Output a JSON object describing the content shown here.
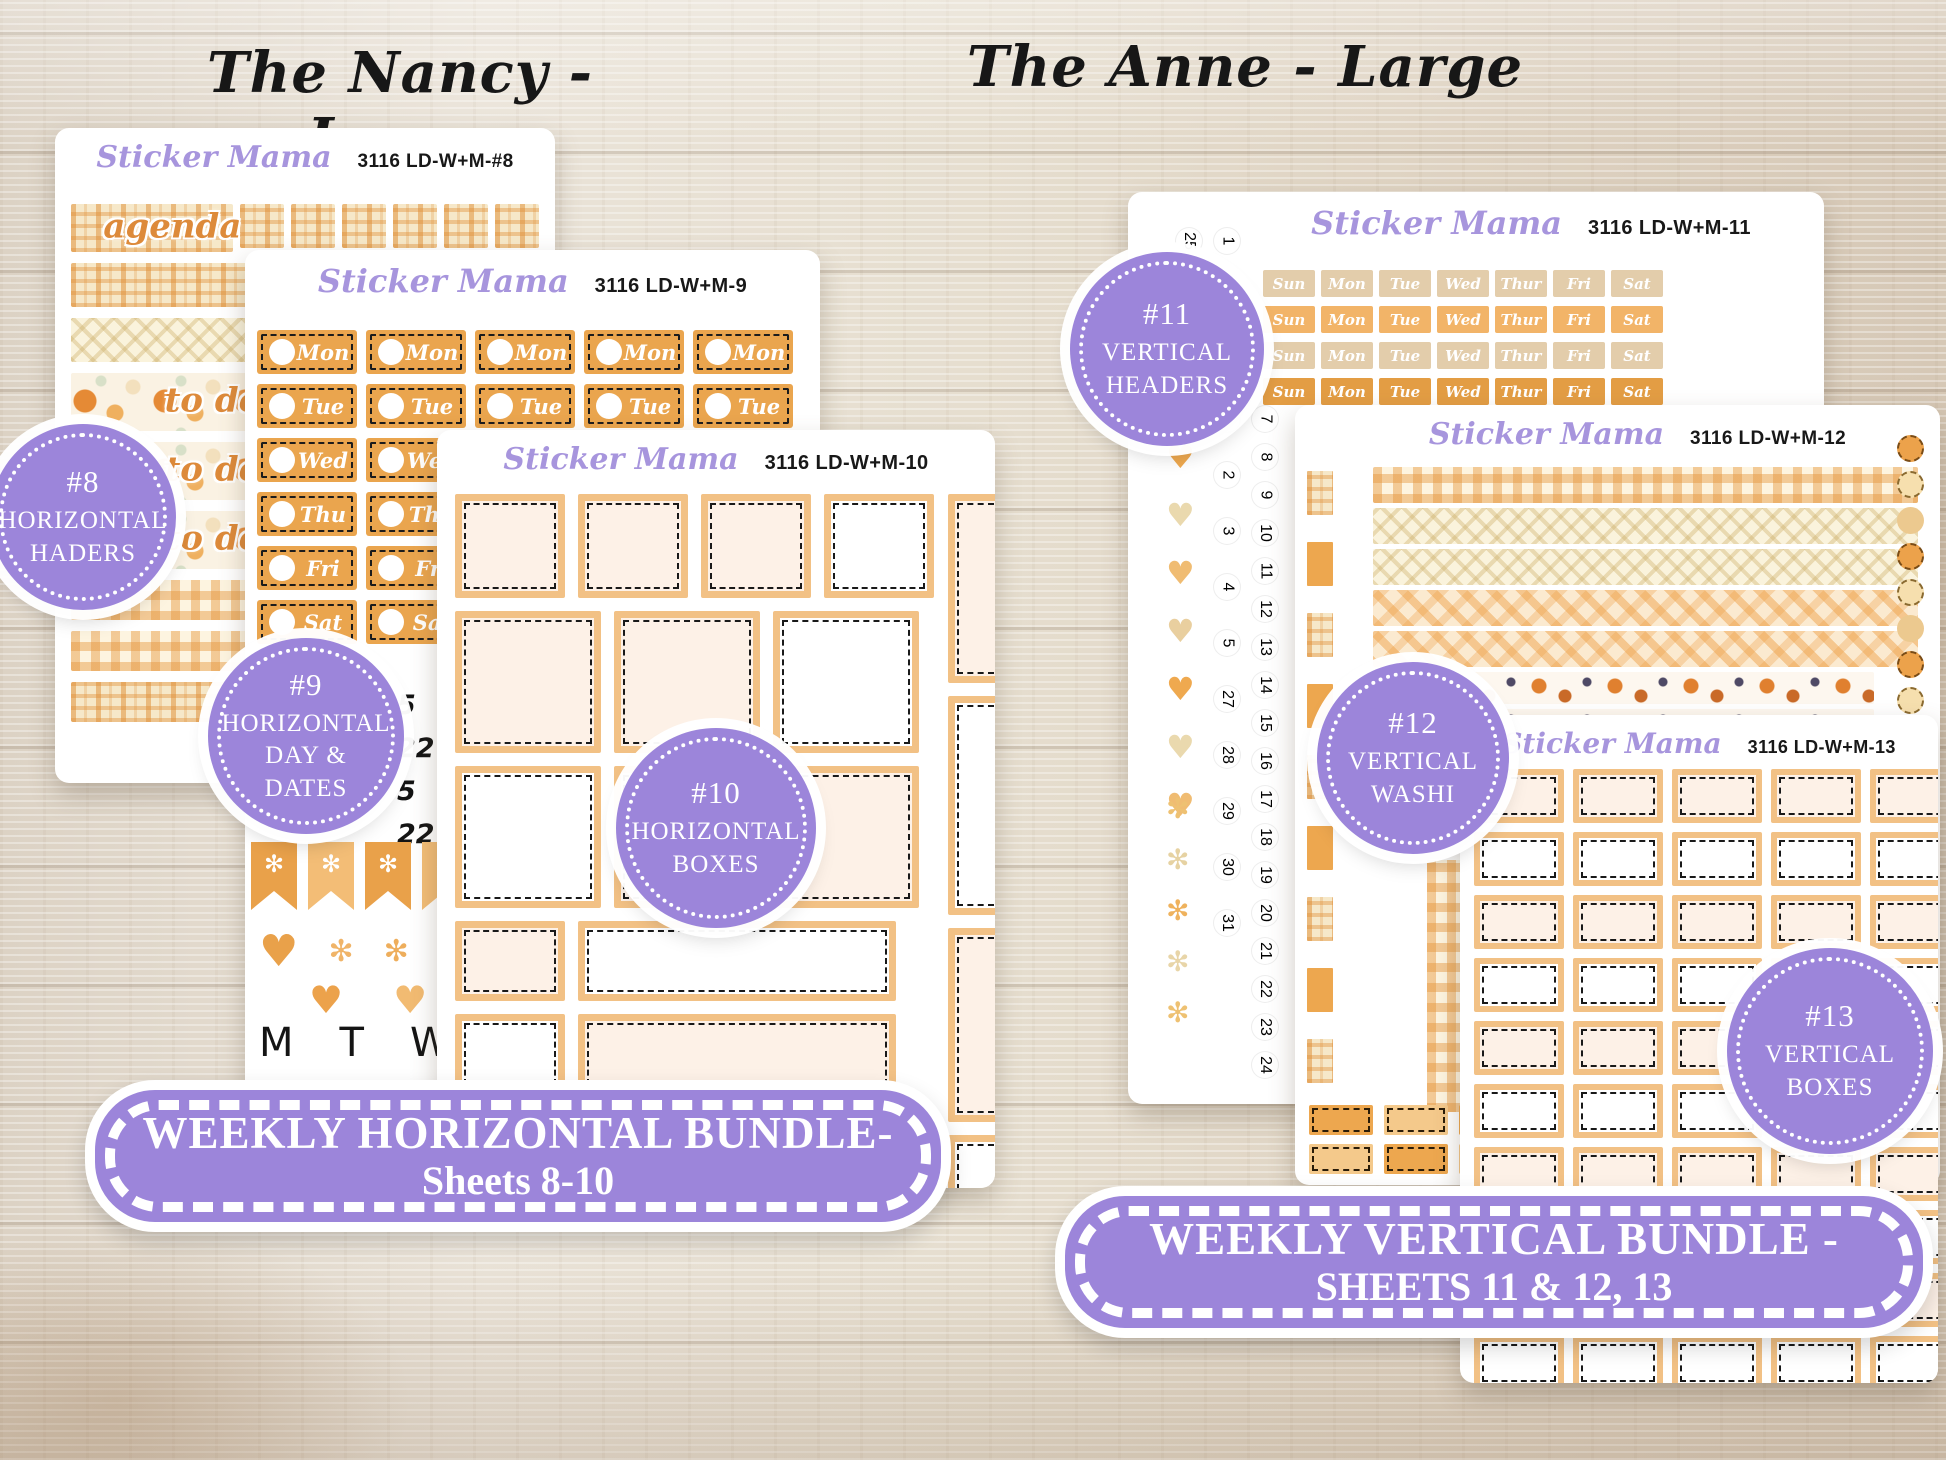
{
  "page": {
    "left_title": "The Nancy - Large",
    "right_title": "The Anne - Large"
  },
  "brand": "Sticker Mama",
  "left": {
    "sheet8": {
      "code": "3116 LD-W+M-#8",
      "washi_words": [
        "agenda",
        "to do",
        "to do",
        "to do"
      ]
    },
    "sheet9": {
      "code": "3116 LD-W+M-9",
      "days": [
        "Mon",
        "Tue",
        "Wed",
        "Thu",
        "Fri",
        "Sat"
      ],
      "dates": [
        "5",
        "22",
        "5",
        "22"
      ],
      "letters": [
        "M",
        "T",
        "W",
        "T"
      ]
    },
    "sheet10": {
      "code": "3116 LD-W+M-10"
    },
    "badges": [
      {
        "num": "#8",
        "l1": "HORIZONTAL",
        "l2": "HADERS",
        "l3": ""
      },
      {
        "num": "#9",
        "l1": "HORIZONTAL",
        "l2": "DAY &",
        "l3": "DATES"
      },
      {
        "num": "#10",
        "l1": "HORIZONTAL",
        "l2": "BOXES",
        "l3": ""
      }
    ],
    "banner": {
      "line1": "WEEKLY HORIZONTAL BUNDLE-",
      "line2": "Sheets 8-10"
    }
  },
  "right": {
    "sheet11": {
      "code": "3116 LD-W+M-11",
      "days": [
        "Sun",
        "Mon",
        "Tue",
        "Wed",
        "Thur",
        "Fri",
        "Sat"
      ],
      "top_dates": [
        "25",
        "1",
        "2",
        "3"
      ],
      "dates_col1": [
        "1",
        "2",
        "3",
        "4",
        "5",
        "27",
        "28",
        "29",
        "30",
        "31"
      ],
      "dates_col2": [
        "7",
        "8",
        "9",
        "10",
        "11",
        "12",
        "13",
        "14",
        "15",
        "16",
        "17",
        "18",
        "19",
        "20",
        "21",
        "22",
        "23",
        "24"
      ]
    },
    "sheet12": {
      "code": "3116 LD-W+M-12"
    },
    "sheet13": {
      "code": "3116 LD-W+M-13"
    },
    "badges": [
      {
        "num": "#11",
        "l1": "VERTICAL",
        "l2": "HEADERS",
        "l3": ""
      },
      {
        "num": "#12",
        "l1": "VERTICAL",
        "l2": "WASHI",
        "l3": ""
      },
      {
        "num": "#13",
        "l1": "VERTICAL",
        "l2": "BOXES",
        "l3": ""
      }
    ],
    "banner": {
      "line1": "WEEKLY VERTICAL BUNDLE -",
      "line2": "SHEETS 11 & 12, 13"
    }
  },
  "colors": {
    "badge_purple": "#9c85da",
    "brand_purple": "#a795dd",
    "sticker_orange": "#eaa54e",
    "sticker_tan": "#e3cdab",
    "sticker_dark_orange": "#e39d44",
    "box_border": "#f2c185",
    "cream_fill": "#fdf1e7"
  }
}
